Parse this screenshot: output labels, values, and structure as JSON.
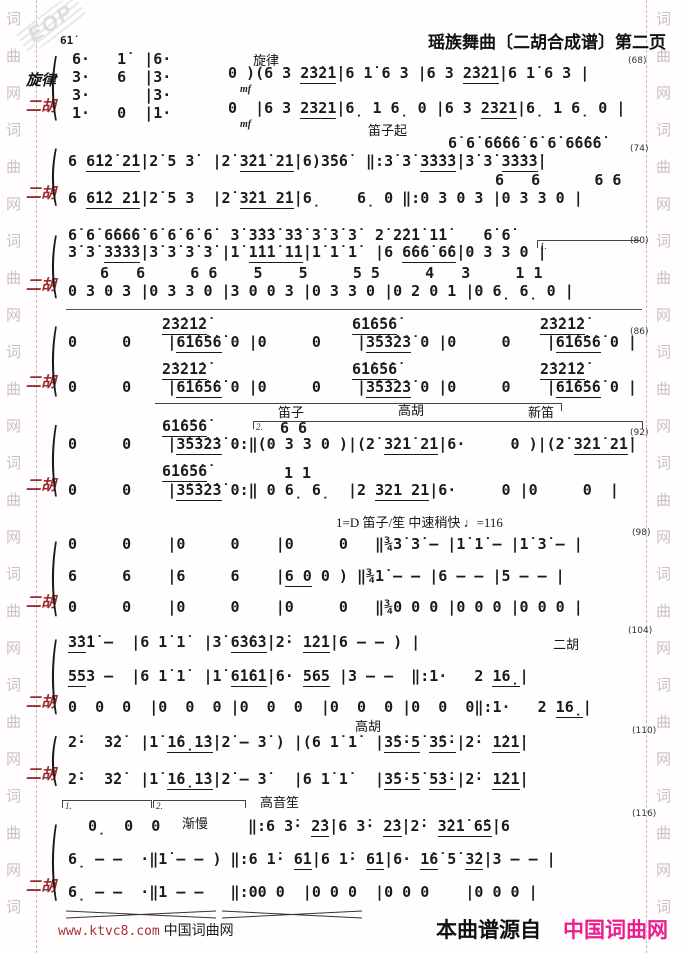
{
  "header": {
    "title": "瑶族舞曲〔二胡合成谱〕第二页"
  },
  "watermark": {
    "logo": "EOP",
    "column": "词曲网词曲网词曲网词曲网词曲网词曲网词曲网词曲网词"
  },
  "footer": {
    "left_url": "www.ktvc8.com",
    "left_site": " 中国词曲网",
    "right_prefix": "本曲谱源自",
    "right_site": "中国词曲网",
    "accent_pink": "#ec1e8c",
    "accent_red": "#a83434"
  },
  "glyphs": {
    "brace": "("
  },
  "label_color_erhu": "#9c2b2b",
  "rows": [
    {
      "x": 60,
      "y": 34,
      "c": "c",
      "t": "6̇1̇"
    },
    {
      "x": 253,
      "y": 50,
      "c": "a",
      "t": "旋律"
    },
    {
      "x": 26,
      "y": 69,
      "c": "lab",
      "t": "旋律"
    },
    {
      "x": 26,
      "y": 95,
      "c": "labr",
      "t": "二胡"
    },
    {
      "x": 72,
      "y": 50,
      "c": "n",
      "t": "6·   1̇  |6·"
    },
    {
      "x": 72,
      "y": 68,
      "c": "n",
      "t": "3·   6  |3·"
    },
    {
      "x": 72,
      "y": 86,
      "c": "n",
      "t": "3·      |3·"
    },
    {
      "x": 72,
      "y": 104,
      "c": "n",
      "t": "1·   0  |1·"
    },
    {
      "x": 228,
      "y": 64,
      "c": "n",
      "t": "0 )(6 3 _2̇3̇2̇1̇_|6 1̇ 6 3 |6 3 _2̇3̇2̇1̇_|6 1̇ 6 3 |"
    },
    {
      "x": 240,
      "y": 84,
      "c": "dyn",
      "t": "mf"
    },
    {
      "x": 228,
      "y": 99,
      "c": "n",
      "t": "0  |6 3 _2321_|6̣ 1 6̣ 0 |6 3 _2321_|6̣ 1 6̣ 0 |"
    },
    {
      "x": 240,
      "y": 119,
      "c": "dyn",
      "t": "mf"
    },
    {
      "x": 628,
      "y": 56,
      "c": "m",
      "t": "(68)"
    },
    {
      "x": 368,
      "y": 120,
      "c": "a",
      "t": "笛子起"
    },
    {
      "x": 448,
      "y": 134,
      "c": "n",
      "t": "6̇ 6̇ 6̇6̇6̇6̇ 6̇ 6̇ 6̇6̇6̇6̇"
    },
    {
      "x": 68,
      "y": 152,
      "c": "n",
      "t": "6 _6̇1̇2̇ 2̇1̇_|2̇ 5 3̇  |2̇ _3̇2̇1̇ 2̇1̇_|6)3̇5̇6̇  ‖:3̇ 3̇ _3̇3̇3̇3̇_|3̇ 3̇ _3̇3̇3̇3̇_|"
    },
    {
      "x": 630,
      "y": 144,
      "c": "m",
      "t": "(74)"
    },
    {
      "x": 495,
      "y": 171,
      "c": "n",
      "t": "6   6      6 6"
    },
    {
      "x": 26,
      "y": 182,
      "c": "labr",
      "t": "二胡"
    },
    {
      "x": 68,
      "y": 189,
      "c": "n",
      "t": "6 _6̇1̇2 2̇1̇_|2̇ 5 3  |2̇ _3̇2̇1 2̇1̇_|6̣    6̣ 0 ‖:0 3 0 3 |0 3 3 0 |"
    },
    {
      "x": 68,
      "y": 226,
      "c": "n",
      "t": "6̇ 6̇ 6̇6̇6̇6̇ 6̇ 6̇ 6̇ 6̇  3̇ 3̇3̇3̇ 3̇3̇ 3̇ 3̇ 3̇  2̇ 2̇2̇1̇ 1̇1̇    6̇ 6̇"
    },
    {
      "x": 68,
      "y": 243,
      "c": "n",
      "t": "3̇ 3̇ _3̇3̇3̇3̇_|3̇ 3̇ 3̇ 3̇ |1̇ _1̇1̇1̇ 1̇1̇_|1̇ 1̇ 1̇  |6 _6̇6̇6̇ 6̇6̇_|0 3 3 0 |"
    },
    {
      "x": 630,
      "y": 236,
      "c": "m",
      "t": "(80)"
    },
    {
      "x": 100,
      "y": 264,
      "c": "n",
      "t": "6   6     6 6    5    5     5 5     4   3     1 1"
    },
    {
      "x": 26,
      "y": 274,
      "c": "labr",
      "t": "二胡"
    },
    {
      "x": 68,
      "y": 282,
      "c": "n",
      "t": "0 3 0 3 |0 3 3 0 |3 0 0 3 |0 3 3 0 |0 2 0 1 |0 6̣ 6̣ 0 |"
    },
    {
      "x": 162,
      "y": 315,
      "c": "n",
      "t": "_2̇3̇2̇1̇2̇_"
    },
    {
      "x": 352,
      "y": 315,
      "c": "n",
      "t": "_6̇1̇6̇5̇6̇_"
    },
    {
      "x": 540,
      "y": 315,
      "c": "n",
      "t": "_2̇3̇2̇1̇2̇_"
    },
    {
      "x": 68,
      "y": 333,
      "c": "n",
      "t": "0     0    |_6̇1̇6̇5̇6̇_ 0 |0     0    |_3̇5̇3̇2̇3̇_ 0 |0     0    |_6̇1̇6̇5̇6̇_ 0 |"
    },
    {
      "x": 630,
      "y": 327,
      "c": "m",
      "t": "(86)"
    },
    {
      "x": 162,
      "y": 360,
      "c": "n",
      "t": "_2̇3̇2̇1̇2̇_"
    },
    {
      "x": 352,
      "y": 360,
      "c": "n",
      "t": "_6̇1̇6̇5̇6̇_"
    },
    {
      "x": 540,
      "y": 360,
      "c": "n",
      "t": "_2̇3̇2̇1̇2̇_"
    },
    {
      "x": 26,
      "y": 371,
      "c": "labr",
      "t": "二胡"
    },
    {
      "x": 68,
      "y": 378,
      "c": "n",
      "t": "0     0    |_6̇1̇6̇5̇6̇_ 0 |0     0    |_3̇5̇3̇2̇3̇_ 0 |0     0    |_6̇1̇6̇5̇6̇_ 0 |"
    },
    {
      "x": 278,
      "y": 402,
      "c": "a",
      "t": "笛子"
    },
    {
      "x": 398,
      "y": 400,
      "c": "a",
      "t": "高胡"
    },
    {
      "x": 528,
      "y": 402,
      "c": "a",
      "t": "新笛"
    },
    {
      "x": 162,
      "y": 417,
      "c": "n",
      "t": "_6̇1̇6̇5̇6̇_"
    },
    {
      "x": 280,
      "y": 419,
      "c": "n",
      "t": "6 6"
    },
    {
      "x": 68,
      "y": 435,
      "c": "n",
      "t": "0     0    |_3̇5̇3̇2̇3̇_ 0:‖(0 3 3 0 )|(2̇ _3̇2̇1̇ 2̇1̇_|6·     0 )|(2̇ _3̇2̇1̇ 2̇1̇_|"
    },
    {
      "x": 630,
      "y": 428,
      "c": "m",
      "t": "(92)"
    },
    {
      "x": 162,
      "y": 462,
      "c": "n",
      "t": "_6̇1̇6̇5̇6̇_"
    },
    {
      "x": 284,
      "y": 464,
      "c": "n",
      "t": "1 1"
    },
    {
      "x": 26,
      "y": 474,
      "c": "labr",
      "t": "二胡"
    },
    {
      "x": 68,
      "y": 481,
      "c": "n",
      "t": "0     0    |_3̇5̇3̇2̇3̇_ 0:‖ 0 6̣ 6̣  |2 _321 21_|6·     0 |0     0  |"
    },
    {
      "x": 336,
      "y": 512,
      "c": "a",
      "t": "1=D 笛子/笙 中速稍快 ♩=116"
    },
    {
      "x": 68,
      "y": 535,
      "c": "n",
      "t": "0     0    |0     0    |0     0   ‖¾3̇ 3̇ – |1̇ 1̇ – |1̇ 3̇ – |"
    },
    {
      "x": 632,
      "y": 528,
      "c": "m",
      "t": "(98)"
    },
    {
      "x": 68,
      "y": 567,
      "c": "n",
      "t": "6     6    |6     6    |_6 0_ 0 ) ‖¾1̇ – – |6 – – |5 – – |"
    },
    {
      "x": 26,
      "y": 591,
      "c": "labr",
      "t": "二胡"
    },
    {
      "x": 68,
      "y": 598,
      "c": "n",
      "t": "0     0    |0     0    |0     0   ‖¾0 0 0 |0 0 0 |0 0 0 |"
    },
    {
      "x": 68,
      "y": 633,
      "c": "n",
      "t": "_3̇3̇_1̇ –  |6 1̇ 1̇  |3̇ _6̇3̇6̇3̇_|2̇· _1̇2̇1̇_|6 – – ) |"
    },
    {
      "x": 553,
      "y": 634,
      "c": "a",
      "t": "二胡"
    },
    {
      "x": 628,
      "y": 626,
      "c": "m",
      "t": "(104)"
    },
    {
      "x": 68,
      "y": 667,
      "c": "n",
      "t": "_55_3 –  |6 1̇ 1̇  |1̇ _6̇1̇6̇1̇_|6· _565_ |3 – –  ‖:1·   2 _16̣_|"
    },
    {
      "x": 26,
      "y": 691,
      "c": "labr",
      "t": "二胡"
    },
    {
      "x": 68,
      "y": 698,
      "c": "n",
      "t": "0  0  0  |0  0  0 |0  0  0  |0  0  0 |0  0  0‖:1·   2 _16̣_|"
    },
    {
      "x": 355,
      "y": 716,
      "c": "a",
      "t": "高胡"
    },
    {
      "x": 68,
      "y": 733,
      "c": "n",
      "t": "2̇·  3̇2̇  |1̇ _1̇6̣1̇3̇_|2̇ – 3̇ ) |(6 1̇ 1̇  |_3̇5̇·5̇_ _3̇5̇·_|2̇· _1̇2̇1̇_|"
    },
    {
      "x": 632,
      "y": 726,
      "c": "m",
      "t": "(110)"
    },
    {
      "x": 26,
      "y": 763,
      "c": "labr",
      "t": "二胡"
    },
    {
      "x": 68,
      "y": 770,
      "c": "n",
      "t": "2̇·  3̇2̇  |1̇ _1̇6̣1̇3̇_|2̇ – 3̇   |6 1̇ 1̇   |_3̇5̇·5̇_ _5̇3̇·_|2̇· _1̇2̇1̇_|"
    },
    {
      "x": 260,
      "y": 792,
      "c": "a",
      "t": "高音笙"
    },
    {
      "x": 88,
      "y": 817,
      "c": "n",
      "t": "0̣  0  0"
    },
    {
      "x": 182,
      "y": 813,
      "c": "a",
      "t": "渐慢"
    },
    {
      "x": 248,
      "y": 817,
      "c": "n",
      "t": "‖:6 3̇· _2̇3̇_|6 3̇· _2̇3̇_|2̇· _3̇2̇1̇ 6̇5̇_|6"
    },
    {
      "x": 632,
      "y": 809,
      "c": "m",
      "t": "(116)"
    },
    {
      "x": 68,
      "y": 850,
      "c": "n",
      "t": "6̣ – –  ·‖1̇ – – ) ‖:6 1̇· _6̇1̇_|6 1̇· _6̇1̇_|6· _1̇6̇_ 5̇ _3̇2̇_|3 – – |"
    },
    {
      "x": 26,
      "y": 875,
      "c": "labr",
      "t": "二胡"
    },
    {
      "x": 68,
      "y": 883,
      "c": "n",
      "t": "6̣ – –  ·‖1 – –   ‖:00 0  |0 0 0  |0 0 0    |0 0 0 |"
    }
  ],
  "separators": [
    {
      "x": 66,
      "y": 309,
      "w": 576
    }
  ],
  "brackets": [
    {
      "x": 537,
      "y": 240,
      "w": 103,
      "label": "1.",
      "ticks": "left"
    },
    {
      "x": 155,
      "y": 403,
      "w": 407,
      "label": "",
      "ticks": "right"
    },
    {
      "x": 253,
      "y": 421,
      "w": 390,
      "label": "2.",
      "ticks": "both"
    },
    {
      "x": 62,
      "y": 800,
      "w": 90,
      "label": "1.",
      "ticks": "both"
    },
    {
      "x": 153,
      "y": 800,
      "w": 93,
      "label": "2.",
      "ticks": "both"
    }
  ],
  "braces": [
    {
      "x": 50,
      "y": 46,
      "h": 72
    },
    {
      "x": 50,
      "y": 140,
      "h": 64
    },
    {
      "x": 50,
      "y": 226,
      "h": 70
    },
    {
      "x": 50,
      "y": 316,
      "h": 78
    },
    {
      "x": 50,
      "y": 414,
      "h": 80
    },
    {
      "x": 50,
      "y": 530,
      "h": 84
    },
    {
      "x": 50,
      "y": 628,
      "h": 84
    },
    {
      "x": 50,
      "y": 728,
      "h": 56
    },
    {
      "x": 50,
      "y": 812,
      "h": 86
    }
  ],
  "hairpins": [
    {
      "x": 66,
      "y": 906,
      "w": 150
    },
    {
      "x": 222,
      "y": 906,
      "w": 140
    }
  ]
}
